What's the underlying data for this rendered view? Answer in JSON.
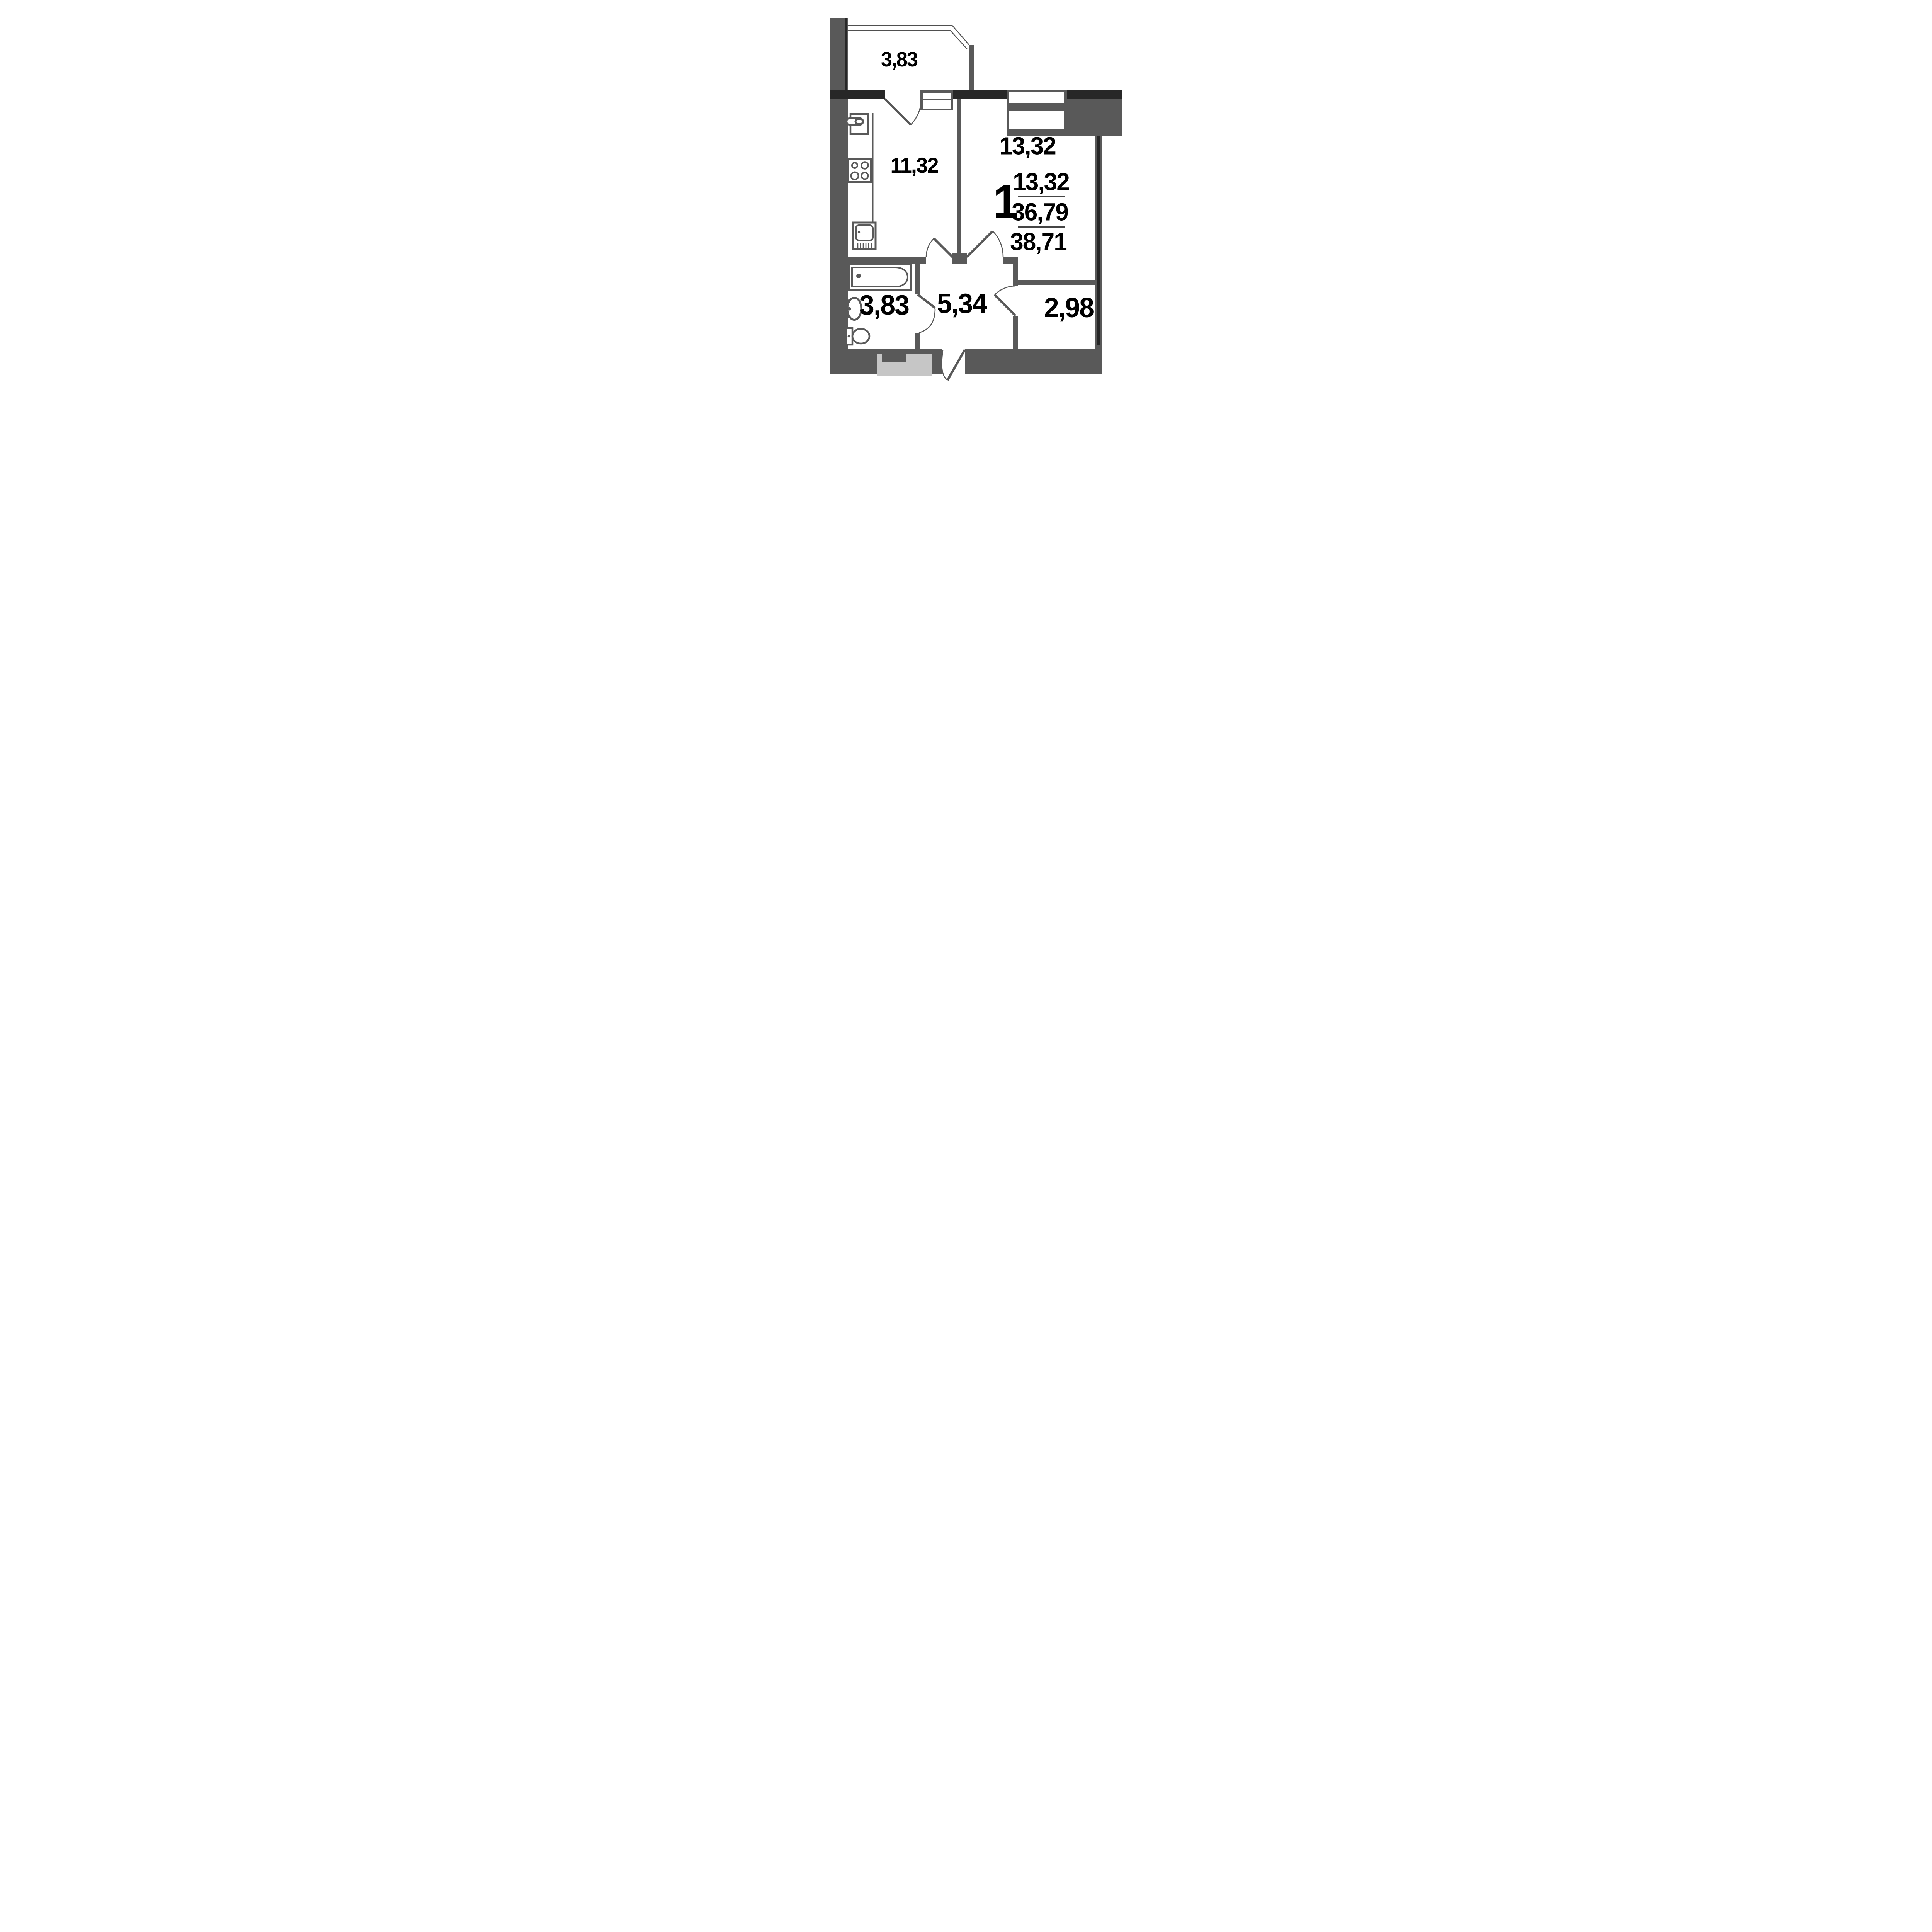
{
  "plan": {
    "type": "apartment-floor-plan",
    "unit_summary": {
      "rooms_count": "1",
      "living_area": "13,32",
      "usable_area": "36,79",
      "total_area": "38,71"
    },
    "rooms": [
      {
        "name": "balcony",
        "area": "3,83"
      },
      {
        "name": "kitchen",
        "area": "11,32"
      },
      {
        "name": "living-room",
        "area": "13,32"
      },
      {
        "name": "hallway",
        "area": "5,34"
      },
      {
        "name": "bathroom",
        "area": "3,83"
      },
      {
        "name": "storage",
        "area": "2,98"
      }
    ],
    "colors": {
      "wall": "#595959",
      "wall_dark": "#272727",
      "entrance_block_light": "#c6c6c6",
      "text": "#000000",
      "background": "#ffffff"
    }
  }
}
